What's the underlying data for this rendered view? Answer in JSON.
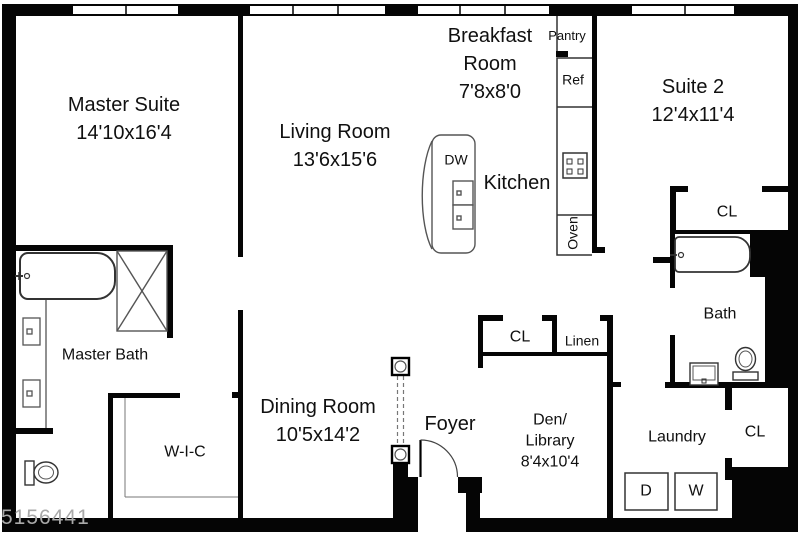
{
  "plan": {
    "watermark": "5156441",
    "colors": {
      "wall": "#000000",
      "fixture": "#444444",
      "watermark": "#a9a9a9"
    },
    "rooms": {
      "master_suite": {
        "name": "Master Suite",
        "dims": "14'10x16'4"
      },
      "living_room": {
        "name": "Living Room",
        "dims": "13'6x15'6"
      },
      "breakfast_room": {
        "name": "Breakfast Room",
        "dims": "7'8x8'0"
      },
      "suite_2": {
        "name": "Suite 2",
        "dims": "12'4x11'4"
      },
      "dining_room": {
        "name": "Dining Room",
        "dims": "10'5x14'2"
      },
      "den_library": {
        "line1": "Den/",
        "line2": "Library",
        "dims": "8'4x10'4"
      },
      "kitchen": {
        "name": "Kitchen"
      },
      "foyer": {
        "name": "Foyer"
      },
      "master_bath": {
        "name": "Master Bath"
      },
      "walk_in_closet": {
        "name": "W-I-C"
      },
      "bath": {
        "name": "Bath"
      },
      "laundry": {
        "name": "Laundry"
      },
      "pantry": {
        "name": "Pantry"
      },
      "linen": {
        "name": "Linen"
      }
    },
    "closets": {
      "suite2": "CL",
      "den": "CL",
      "laundry": "CL"
    },
    "appliances": {
      "refrigerator": "Ref",
      "oven": "Oven",
      "dishwasher": "DW",
      "dryer": "D",
      "washer": "W"
    }
  }
}
